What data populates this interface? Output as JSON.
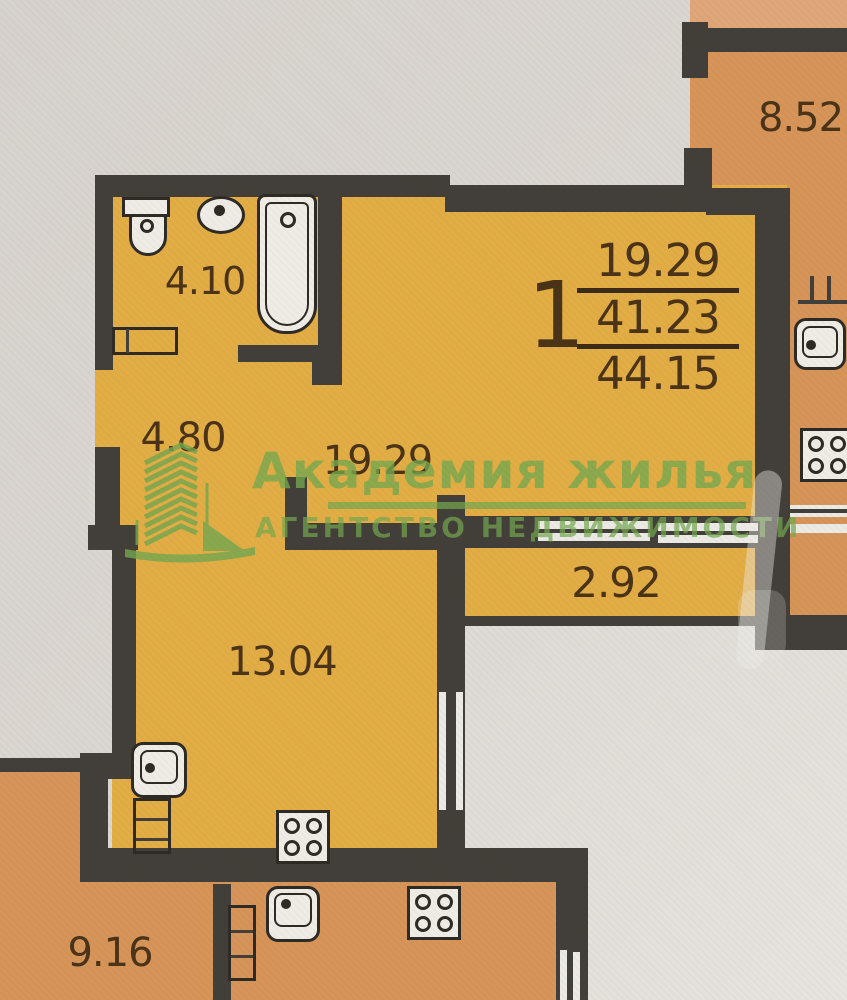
{
  "apartment": {
    "number": "1",
    "living_area": "19.29",
    "area_no_balcony": "41.23",
    "total_area": "44.15"
  },
  "room_areas": {
    "bathroom": "4.10",
    "hallway": "4.80",
    "living_room": "19.29",
    "balcony": "2.92",
    "kitchen": "13.04",
    "neighbor_unit_bottom": "9.16",
    "neighbor_unit_top": "8.52"
  },
  "watermark": {
    "agency_name": "Академия жилья",
    "agency_tagline": "АГЕНТСТВО НЕДВИЖИМОСТИ"
  },
  "colors": {
    "apartment_fill": "#e2ad45",
    "neighbor_fill": "#d69459",
    "neighbor_fill_light": "#dfa779",
    "wall": "#423e39",
    "fixture_fill": "#efece6",
    "fixture_outline": "#2e2a25",
    "label_text": "#4b3318",
    "watermark_green": "#74a850",
    "paper": "#dad6d1"
  }
}
